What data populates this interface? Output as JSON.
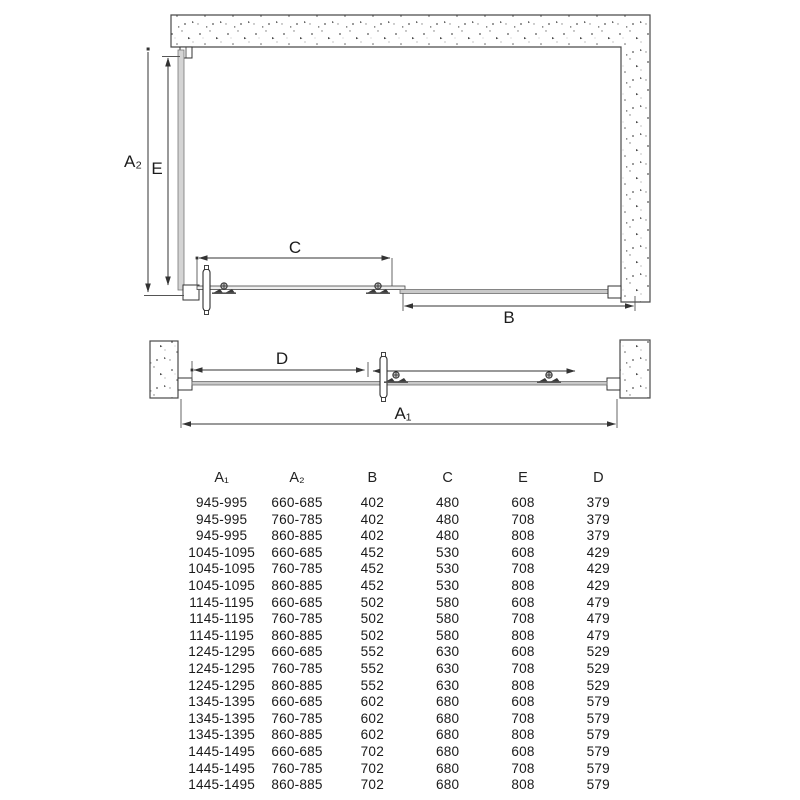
{
  "diagram": {
    "plan_view": {
      "labels": {
        "a2": "A₂",
        "e": "E",
        "c": "C",
        "b": "B"
      }
    },
    "niche_view": {
      "labels": {
        "d": "D",
        "a1": "A₁"
      }
    },
    "colors": {
      "dimension_line": "#333333",
      "wall_outline": "#4a4a4a",
      "glass_fill": "#c9c9c9",
      "background": "#ffffff"
    }
  },
  "table": {
    "columns": [
      "A₁",
      "A₂",
      "B",
      "C",
      "E",
      "D"
    ],
    "rows": [
      [
        "945-995",
        "660-685",
        "402",
        "480",
        "608",
        "379"
      ],
      [
        "945-995",
        "760-785",
        "402",
        "480",
        "708",
        "379"
      ],
      [
        "945-995",
        "860-885",
        "402",
        "480",
        "808",
        "379"
      ],
      [
        "1045-1095",
        "660-685",
        "452",
        "530",
        "608",
        "429"
      ],
      [
        "1045-1095",
        "760-785",
        "452",
        "530",
        "708",
        "429"
      ],
      [
        "1045-1095",
        "860-885",
        "452",
        "530",
        "808",
        "429"
      ],
      [
        "1145-1195",
        "660-685",
        "502",
        "580",
        "608",
        "479"
      ],
      [
        "1145-1195",
        "760-785",
        "502",
        "580",
        "708",
        "479"
      ],
      [
        "1145-1195",
        "860-885",
        "502",
        "580",
        "808",
        "479"
      ],
      [
        "1245-1295",
        "660-685",
        "552",
        "630",
        "608",
        "529"
      ],
      [
        "1245-1295",
        "760-785",
        "552",
        "630",
        "708",
        "529"
      ],
      [
        "1245-1295",
        "860-885",
        "552",
        "630",
        "808",
        "529"
      ],
      [
        "1345-1395",
        "660-685",
        "602",
        "680",
        "608",
        "579"
      ],
      [
        "1345-1395",
        "760-785",
        "602",
        "680",
        "708",
        "579"
      ],
      [
        "1345-1395",
        "860-885",
        "602",
        "680",
        "808",
        "579"
      ],
      [
        "1445-1495",
        "660-685",
        "702",
        "680",
        "608",
        "579"
      ],
      [
        "1445-1495",
        "760-785",
        "702",
        "680",
        "708",
        "579"
      ],
      [
        "1445-1495",
        "860-885",
        "702",
        "680",
        "808",
        "579"
      ]
    ]
  }
}
